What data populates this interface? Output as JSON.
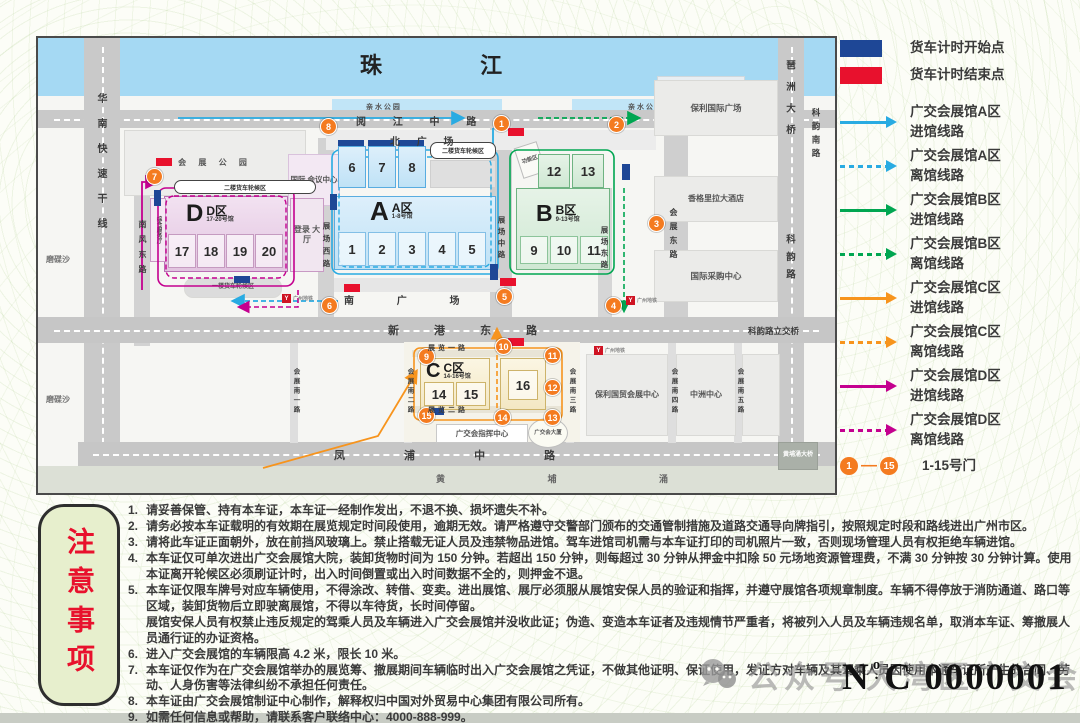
{
  "map": {
    "river": "珠    江",
    "park_left": "亲 水 公 园",
    "park_right": "亲 水 公 园",
    "pier": "港 澳 码 头",
    "metro": "广州地铁",
    "roads": {
      "yuejiang": "阅 江 中 路",
      "north_plaza": "北 广 场",
      "south_plaza": "南 广 场",
      "xingang": "新 港 东 路",
      "fengpu": "凤 浦 中 路",
      "huanan": "华南快速干线",
      "nanfeng": "南风东路",
      "zc_west": "展场西路",
      "zc_mid": "展场中路",
      "zc_east": "展场东路",
      "hz_east": "会展东路",
      "keyun": "科韵路",
      "keyun_south": "科韵南路",
      "pazhou_bridge": "琶洲大桥",
      "interchange": "科韵路立交桥",
      "s1": "会展南一路",
      "s2": "会展南二路",
      "s3": "会展南三路",
      "s4": "会展南四路",
      "s5": "会展南五路",
      "zl1": "展览一路",
      "zl2": "展览二路",
      "huangpu": "黄 埔 涌",
      "huangpu_bridge": "黄埔涌大桥",
      "modiesha": "磨碟沙"
    },
    "buildings": {
      "park": "会 展 公 园",
      "conf": "国际 会议中心",
      "login": "登录 大厅",
      "service": "综合服务厅",
      "func": "功能区",
      "poly_plaza": "保利国际广场",
      "shangrila": "香格里拉大酒店",
      "purchase": "国际采购中心",
      "poly_trade": "保利国贸会展中心",
      "zhongzhou": "中洲中心",
      "command": "广交会指挥中心",
      "tower": "广交会大厦",
      "wait2a": "二楼货车轮候区",
      "wait2d": "二楼货车轮候区",
      "wait1d": "一楼货车轮候区"
    },
    "halls": {
      "a": {
        "letter": "A",
        "zone": "A区",
        "sub": "1-8号馆",
        "top": [
          "6",
          "7",
          "8"
        ],
        "bottom": [
          "1",
          "2",
          "3",
          "4",
          "5"
        ]
      },
      "b": {
        "letter": "B",
        "zone": "B区",
        "sub": "9-13号馆",
        "top": [
          "12",
          "13"
        ],
        "bottom": [
          "9",
          "10",
          "11"
        ]
      },
      "c": {
        "letter": "C",
        "zone": "C区",
        "sub": "14-16号馆",
        "cells": [
          "14",
          "15",
          "16"
        ]
      },
      "d": {
        "letter": "D",
        "zone": "D区",
        "sub": "17-20号馆",
        "cells": [
          "17",
          "18",
          "19",
          "20"
        ]
      }
    },
    "gates": [
      "1",
      "2",
      "3",
      "4",
      "5",
      "6",
      "7",
      "8",
      "9",
      "10",
      "11",
      "12",
      "13",
      "14",
      "15"
    ]
  },
  "legend": {
    "items": [
      {
        "kind": "swatch",
        "color": "#1e4796",
        "label1": "货车计时开始点",
        "label2": ""
      },
      {
        "kind": "swatch",
        "color": "#e8112d",
        "label1": "货车计时结束点",
        "label2": ""
      },
      {
        "kind": "arrow-solid",
        "color": "#29abe2",
        "label1": "广交会展馆A区",
        "label2": "进馆线路"
      },
      {
        "kind": "arrow-dashed",
        "color": "#29abe2",
        "label1": "广交会展馆A区",
        "label2": "离馆线路"
      },
      {
        "kind": "arrow-solid",
        "color": "#00a651",
        "label1": "广交会展馆B区",
        "label2": "进馆线路"
      },
      {
        "kind": "arrow-dashed",
        "color": "#00a651",
        "label1": "广交会展馆B区",
        "label2": "离馆线路"
      },
      {
        "kind": "arrow-solid",
        "color": "#f7941d",
        "label1": "广交会展馆C区",
        "label2": "进馆线路"
      },
      {
        "kind": "arrow-dashed",
        "color": "#f7941d",
        "label1": "广交会展馆C区",
        "label2": "离馆线路"
      },
      {
        "kind": "arrow-solid",
        "color": "#c4008f",
        "label1": "广交会展馆D区",
        "label2": "进馆线路"
      },
      {
        "kind": "arrow-dashed",
        "color": "#c4008f",
        "label1": "广交会展馆D区",
        "label2": "离馆线路"
      }
    ],
    "gates": {
      "first": "1",
      "last": "15",
      "dash": "—",
      "label": "1-15号门"
    }
  },
  "notes": {
    "title": "注意事项",
    "items": [
      {
        "n": "1.",
        "text": "请妥善保管、持有本车证，本车证一经制作发出，不退不换、损坏遗失不补。"
      },
      {
        "n": "2.",
        "text": "请务必按本车证载明的有效期在展览规定时间段使用，逾期无效。请严格遵守交警部门颁布的交通管制措施及道路交通导向牌指引，按照规定时段和路线进出广州市区。"
      },
      {
        "n": "3.",
        "text": "请将此车证正面朝外，放在前挡风玻璃上。禁止搭载无证人员及违禁物品进馆。驾车进馆司机需与本车证打印的司机照片一致，否则现场管理人员有权拒绝车辆进馆。"
      },
      {
        "n": "4.",
        "text": "本车证仅可单次进出广交会展馆大院，装卸货物时间为 150 分钟。若超出 150 分钟，则每超过 30 分钟从押金中扣除 50 元场地资源管理费，不满 30 分钟按 30 分钟计算。使用本证离开轮候区必须刷证计时，出入时间倒置或出入时间数据不全的，则押金不退。"
      },
      {
        "n": "5.",
        "text": "本车证仅限车牌号对应车辆使用，不得涂改、转借、变卖。进出展馆、展厅必须服从展馆安保人员的验证和指挥，并遵守展馆各项规章制度。车辆不得停放于消防通道、路口等区域，装卸货物后立即驶离展馆，不得以车待货，长时间停留。\n展馆安保人员有权禁止违反规定的驾乘人员及车辆进入广交会展馆并没收此证；伪造、变造本车证者及违规情节严重者，将被列入人员及车辆违规名单，取消本车证、筹撤展人员通行证的办证资格。"
      },
      {
        "n": "6.",
        "text": "进入广交会展馆的车辆限高 4.2 米，限长 10 米。"
      },
      {
        "n": "7.",
        "text": "本车证仅作为在广交会展馆举办的展览筹、撤展期间车辆临时出入广交会展馆之凭证，不做其他证明、保证使用，发证方对车辆及其驾乘人员因使用本通车证所产生的合同、劳动、人身伤害等法律纠纷不承担任何责任。"
      },
      {
        "n": "8.",
        "text": "本车证由广交会展馆制证中心制作，解释权归中国对外贸易中心集团有限公司所有。"
      },
      {
        "n": "9.",
        "text": "如需任何信息或帮助，请联系客户联络中心：4000-888-999。"
      }
    ]
  },
  "footer": {
    "wechat_label": "公众号",
    "account": "大湾区广交会",
    "serial": {
      "n": "N",
      "o": "o",
      "dot": ".",
      "rest": "C 0000001"
    }
  }
}
